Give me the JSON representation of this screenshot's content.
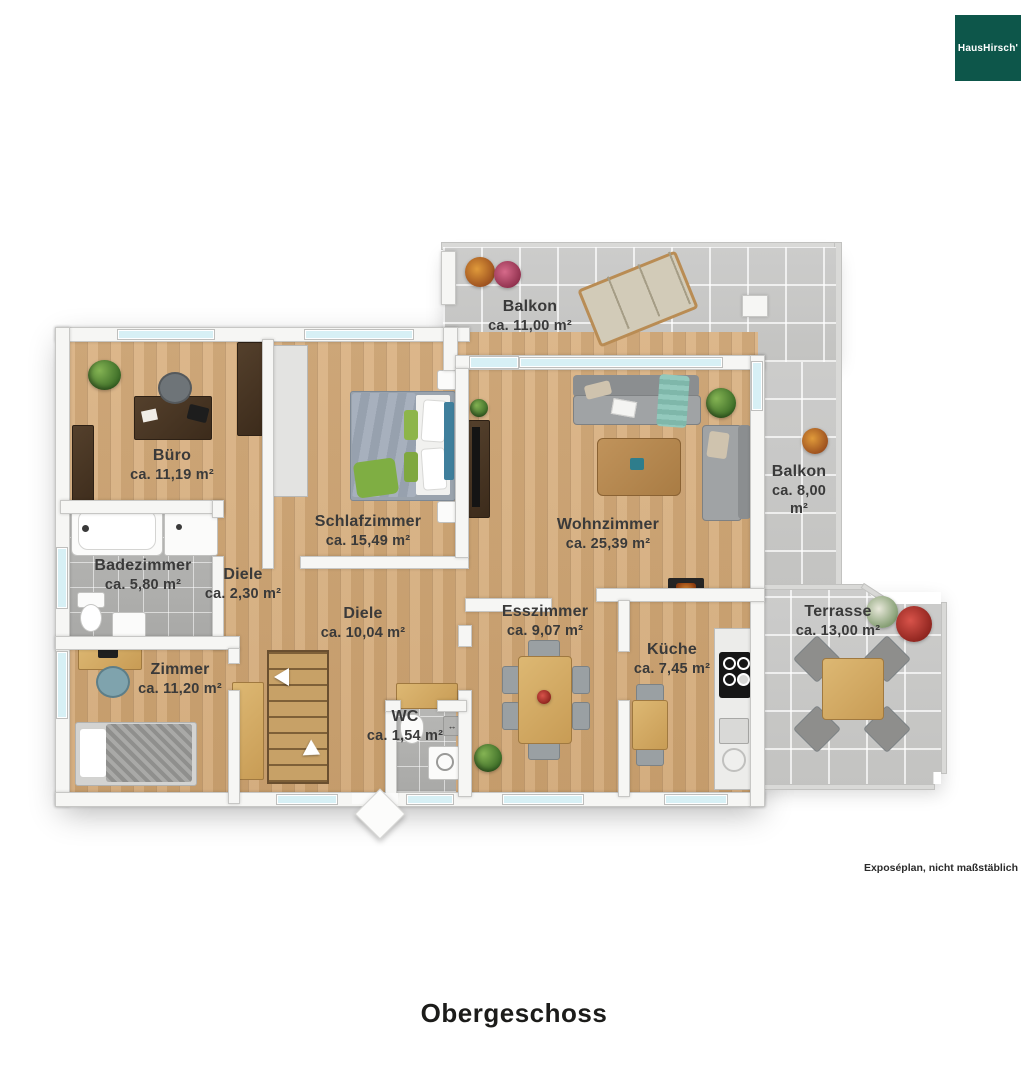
{
  "brand": {
    "logo_text": "HausHirsch'"
  },
  "plan_title": "Obergeschoss",
  "disclaimer": "Exposéplan, nicht maßstäblich",
  "rooms": [
    {
      "name": "Büro",
      "area": "ca. 11,19 m²"
    },
    {
      "name": "Schlafzimmer",
      "area": "ca. 15,49 m²"
    },
    {
      "name": "Badezimmer",
      "area": "ca. 5,80 m²"
    },
    {
      "name": "Diele",
      "area": "ca. 2,30 m²"
    },
    {
      "name": "Diele",
      "area": "ca. 10,04 m²"
    },
    {
      "name": "Zimmer",
      "area": "ca. 11,20 m²"
    },
    {
      "name": "WC",
      "area": "ca. 1,54 m²"
    },
    {
      "name": "Esszimmer",
      "area": "ca. 9,07 m²"
    },
    {
      "name": "Küche",
      "area": "ca. 7,45 m²"
    },
    {
      "name": "Wohnzimmer",
      "area": "ca. 25,39 m²"
    },
    {
      "name": "Balkon",
      "area": "ca. 11,00 m²"
    },
    {
      "name": "Balkon",
      "area": "ca. 8,00 m²"
    },
    {
      "name": "Terrasse",
      "area": "ca. 13,00 m²"
    }
  ],
  "colors": {
    "logo_green": "#0d564a",
    "wood_floor": "#d6ab77",
    "tile_gray": "#b4b4b2",
    "concrete_gray": "#cbcbc9",
    "label_text": "#3a3a3a"
  }
}
